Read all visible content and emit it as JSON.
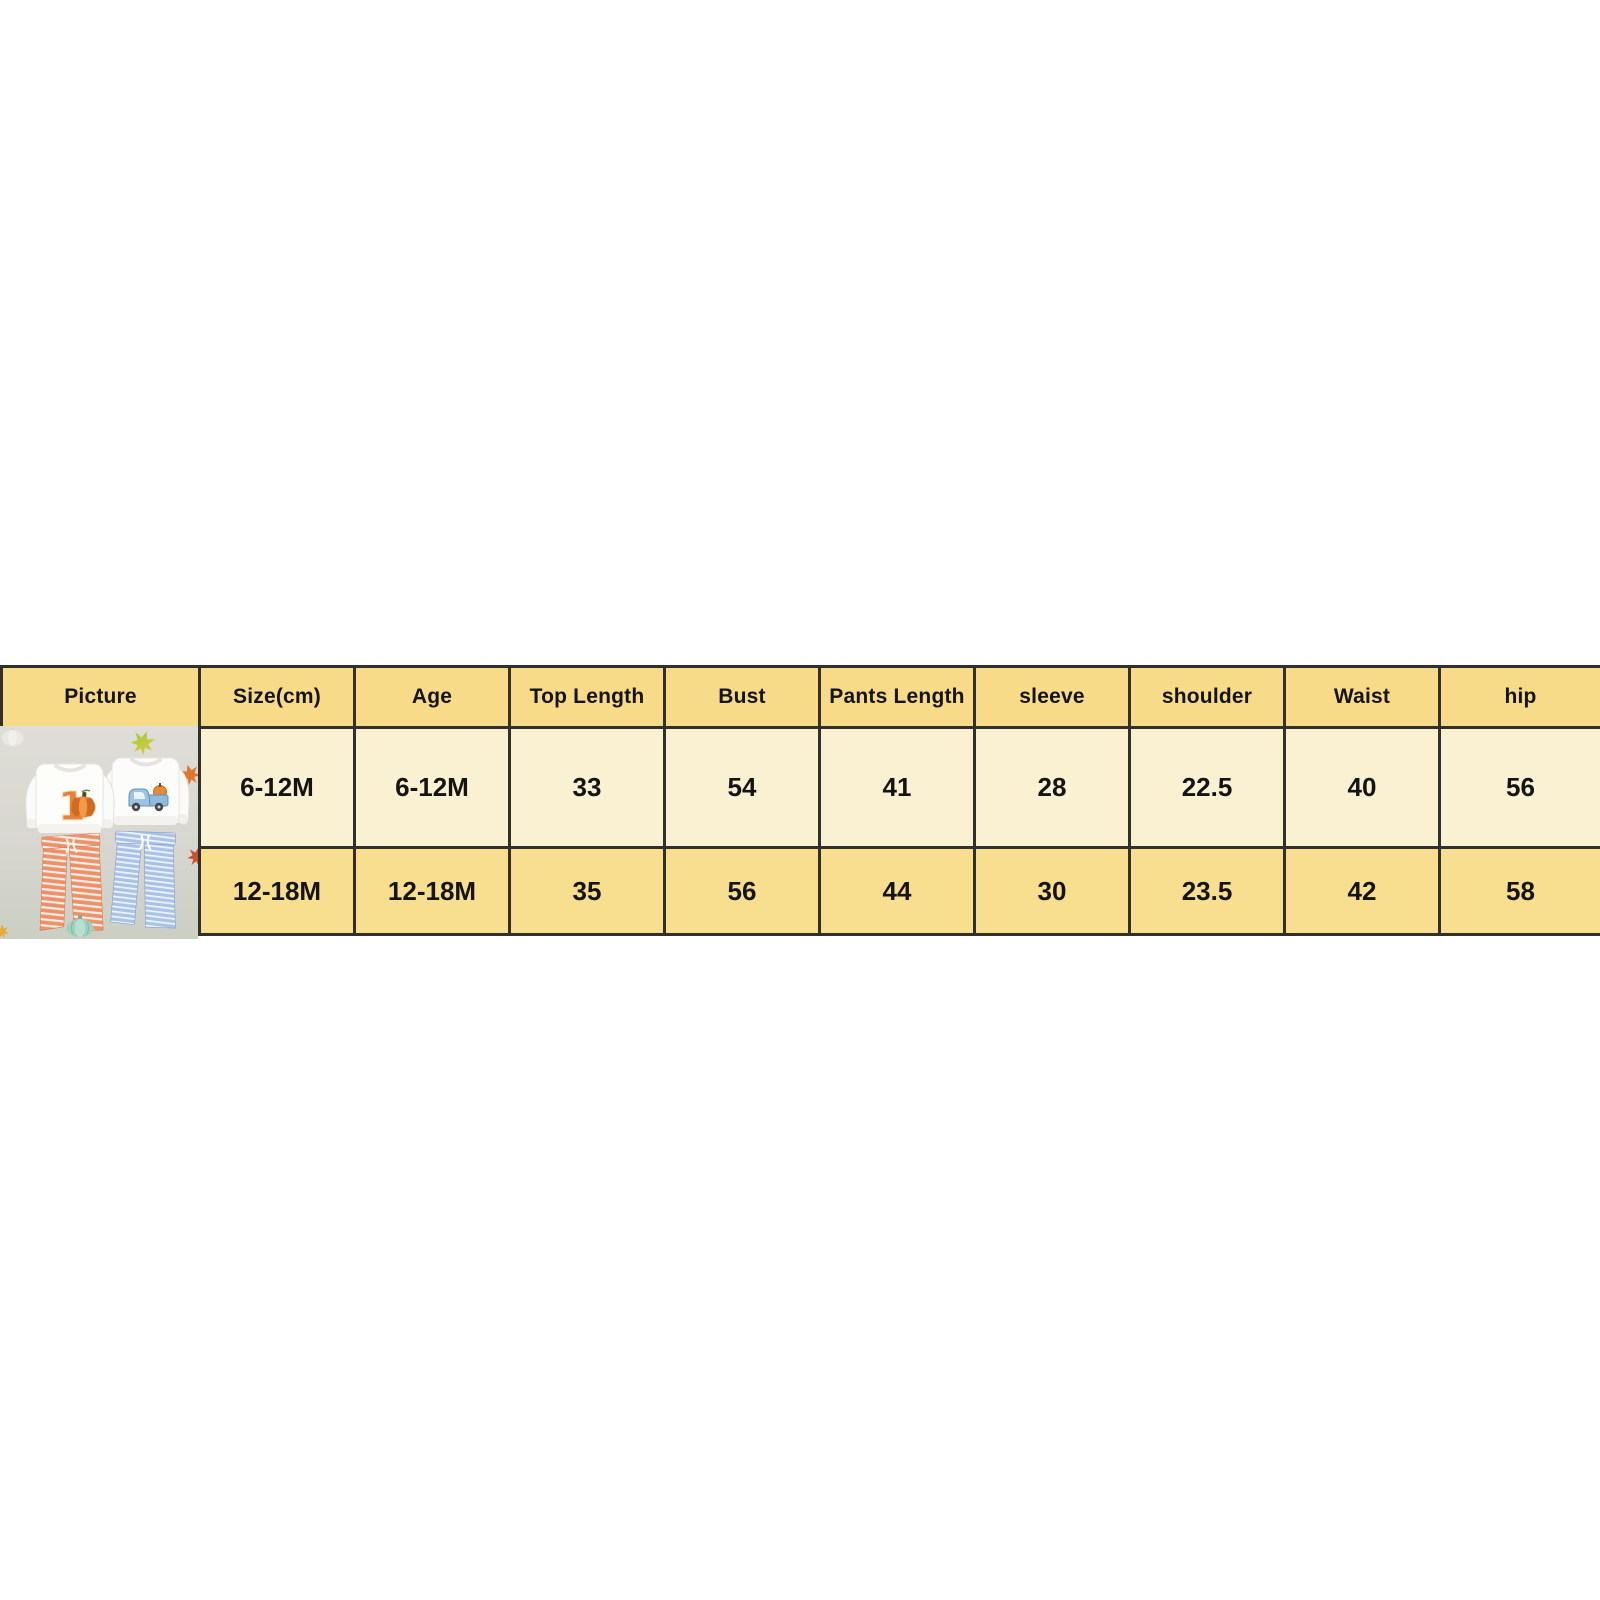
{
  "chart_data": {
    "type": "table",
    "title": "Baby outfit size chart (cm)",
    "columns": [
      "Picture",
      "Size(cm)",
      "Age",
      "Top Length",
      "Bust",
      "Pants Length",
      "sleeve",
      "shoulder",
      "Waist",
      "hip"
    ],
    "rows": [
      [
        "6-12M",
        "6-12M",
        "33",
        "54",
        "41",
        "28",
        "22.5",
        "40",
        "56"
      ],
      [
        "12-18M",
        "12-18M",
        "35",
        "56",
        "44",
        "30",
        "23.5",
        "42",
        "58"
      ]
    ]
  },
  "colors": {
    "header_bg": "#f8db89",
    "row1_bg": "#faf1d2",
    "row2_bg": "#f8de8f",
    "border": "#32302a",
    "photo_bg_top": "#dfddd7",
    "photo_bg_bottom": "#cbcfc3",
    "orange_pants": "#ee9168",
    "blue_pants": "#a9c2e8",
    "pumpkin_orange": "#e8812e",
    "truck_blue": "#8fbcde",
    "teal_pumpkin": "#9fd1c0"
  },
  "photo": {
    "alt": "Two toddler outfit sets: white sweatshirt with pumpkin number one and orange striped pants, white sweatshirt with blue truck and blue striped pants, fall leaves decor",
    "graphic_number": "1"
  }
}
